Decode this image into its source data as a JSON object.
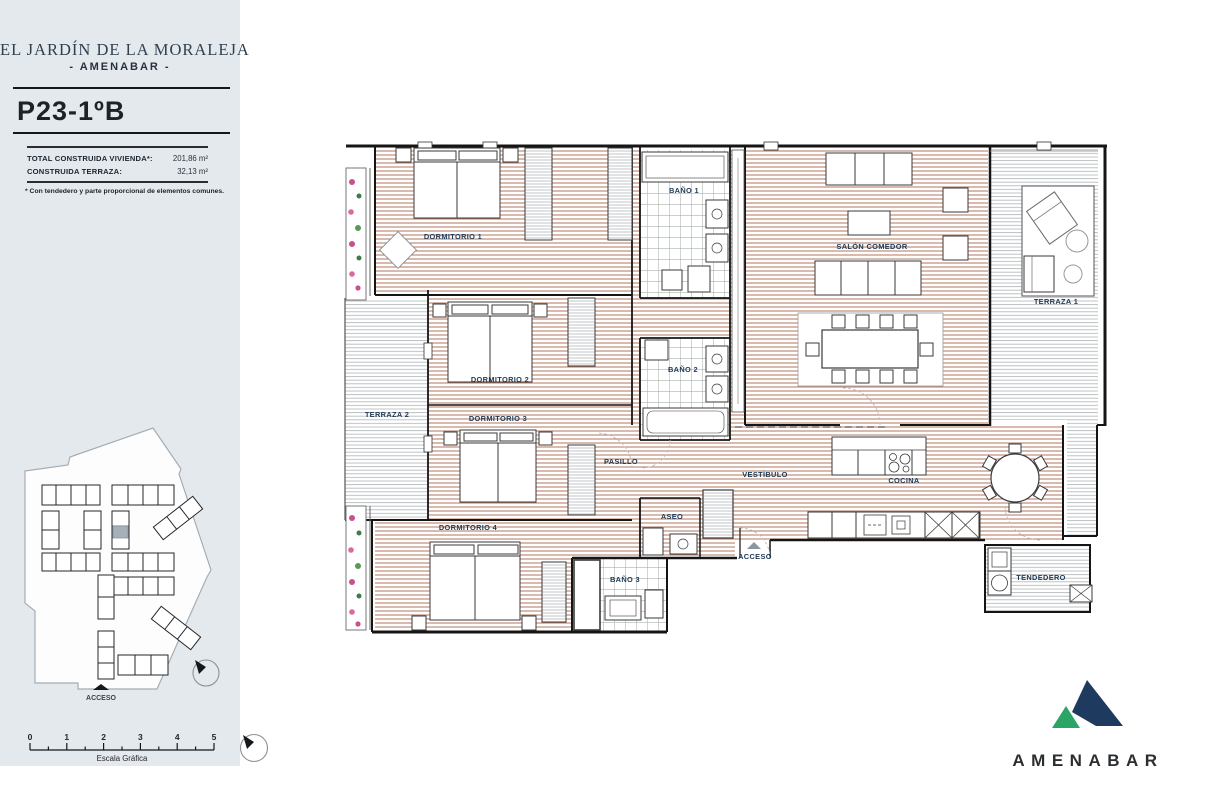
{
  "sheet": {
    "project_title": "EL JARDÍN DE LA MORALEJA",
    "brand_line": "- AMENABAR -",
    "unit_code": "P23-1ºB",
    "area_table": {
      "rows": [
        {
          "label": "TOTAL CONSTRUIDA VIVIENDA*:",
          "value": "201,86 m²"
        },
        {
          "label": "CONSTRUIDA TERRAZA:",
          "value": "32,13 m²"
        }
      ]
    },
    "footnote": "* Con tendedero y parte proporcional de elementos comunes.",
    "site_plan": {
      "access_label": "ACCESO"
    },
    "scale_bar": {
      "ticks": [
        "0",
        "1",
        "2",
        "3",
        "4",
        "5"
      ],
      "caption": "Escala Gráfica"
    }
  },
  "floor_plan": {
    "rooms": [
      {
        "label": "DORMITORIO 1"
      },
      {
        "label": "BAÑO 1"
      },
      {
        "label": "SALÓN COMEDOR"
      },
      {
        "label": "TERRAZA 1"
      },
      {
        "label": "DORMITORIO 2"
      },
      {
        "label": "BAÑO 2"
      },
      {
        "label": "TERRAZA 2"
      },
      {
        "label": "DORMITORIO 3"
      },
      {
        "label": "PASILLO"
      },
      {
        "label": "VESTÍBULO"
      },
      {
        "label": "ASEO"
      },
      {
        "label": "COCINA"
      },
      {
        "label": "DORMITORIO 4"
      },
      {
        "label": "BAÑO 3"
      },
      {
        "label": "TENDEDERO"
      }
    ],
    "access_label": "ACCESO"
  },
  "logo": {
    "wordmark": "AMENABAR"
  },
  "colors": {
    "sidebar_bg": "#e4e9ee",
    "wood_hatch": "#b3765f",
    "terrace_hatch": "#b6bbbf",
    "tile_grid": "#96a29a",
    "label_navy": "#1d3a56",
    "logo_green": "#2aa566",
    "logo_navy": "#1e3a5e"
  }
}
